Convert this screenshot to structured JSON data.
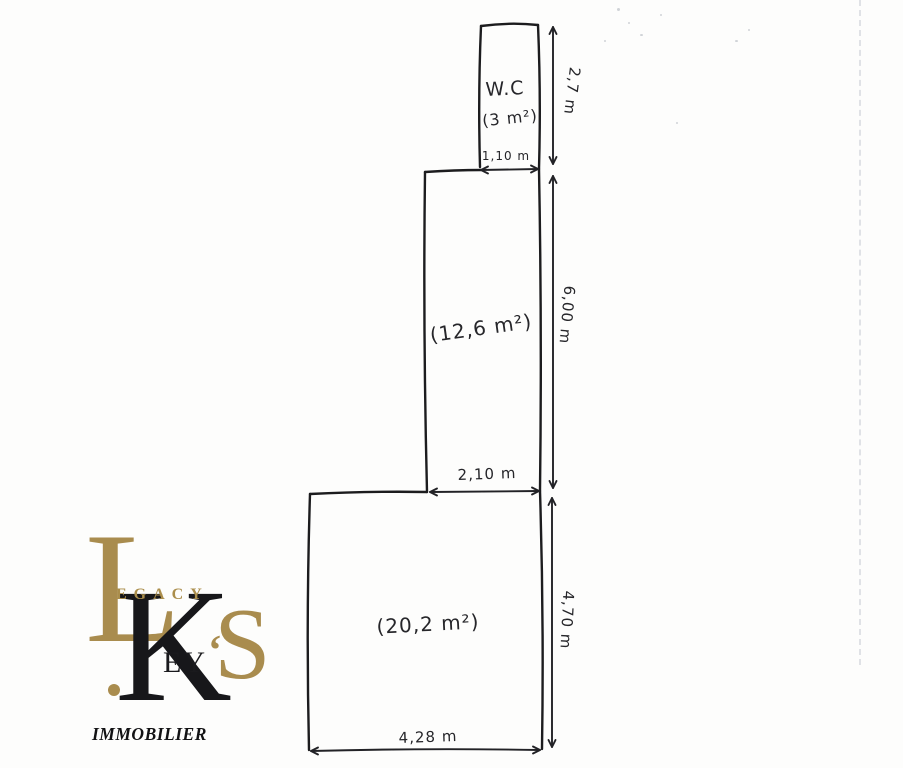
{
  "plan": {
    "wc": {
      "label": "W.C",
      "area": "(3 m²)",
      "width": "1,10 m",
      "height": "2,7 m"
    },
    "middle_room": {
      "area": "(12,6 m²)",
      "width": "2,10 m",
      "height": "6,00 m"
    },
    "main_room": {
      "area": "(20,2 m²)",
      "width": "4,28 m",
      "height": "4,70 m"
    }
  },
  "logo": {
    "brand_top_initial": "L",
    "brand_top_rest": "EGACY",
    "brand_main_initial": "K",
    "brand_main_rest": "EY",
    "apostrophe": "‘",
    "brand_s": "S",
    "subtitle": "IMMOBILIER",
    "gold": "#a98c4e",
    "black": "#17171a"
  },
  "colors": {
    "ink": "#1c1c1e",
    "paper": "#fdfdfc"
  }
}
